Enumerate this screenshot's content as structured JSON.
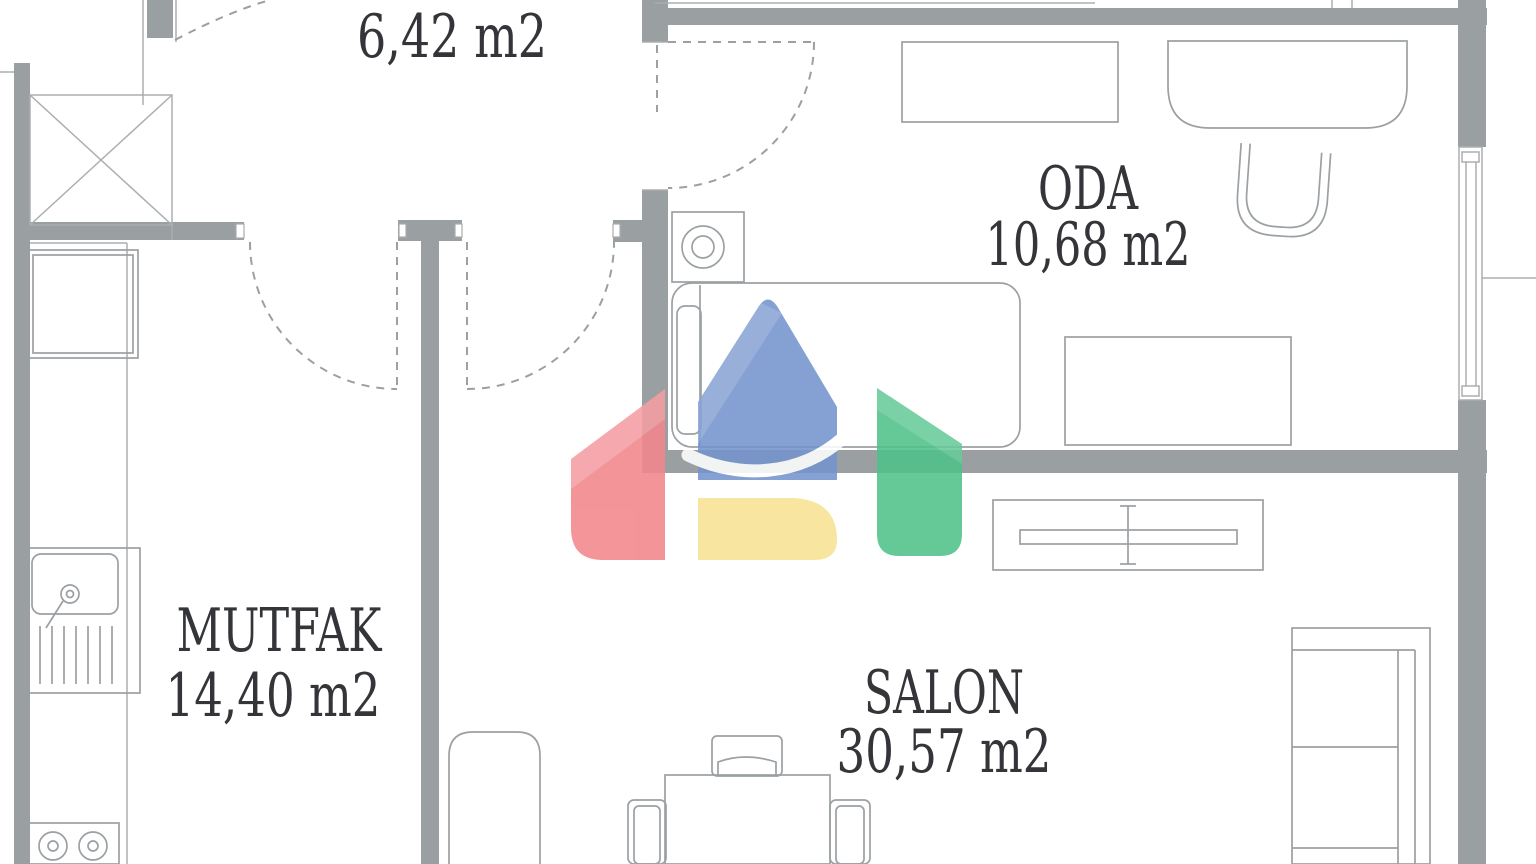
{
  "plan": {
    "rooms": [
      {
        "id": "hall",
        "name": "",
        "area_label": "6,42 m2"
      },
      {
        "id": "oda",
        "name": "ODA",
        "area_label": "10,68 m2"
      },
      {
        "id": "mutfak",
        "name": "MUTFAK",
        "area_label": "14,40 m2"
      },
      {
        "id": "salon",
        "name": "SALON",
        "area_label": "30,57 m2"
      }
    ],
    "colors": {
      "wall": "#9aa0a2",
      "line": "#abaeb0",
      "furniture": "#9ba0a3",
      "text": "#343539",
      "background": "#ffffff",
      "logo_red": "#f2868c",
      "logo_blue": "#7594cd",
      "logo_green": "#4fc289",
      "logo_yellow": "#f8e394"
    },
    "icons": {
      "watermark": "house-logo"
    }
  }
}
